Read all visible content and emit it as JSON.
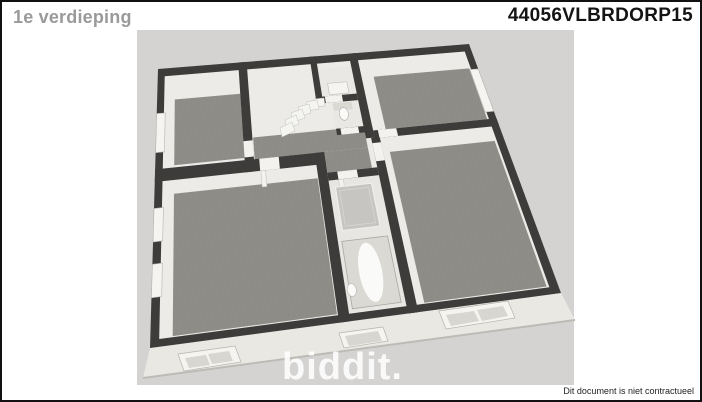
{
  "header": {
    "title": "1e verdieping",
    "code": "44056VLBRDORP15"
  },
  "watermark": {
    "text": "biddit."
  },
  "footer": {
    "disclaimer": "Dit document is niet contractueel"
  },
  "floorplan": {
    "type": "isometric-3d-floor-plan",
    "floor": "first floor",
    "rooms_visible": [
      "bedroom-top-left",
      "stair-hall-with-stairs",
      "wc-room",
      "toilet-nook",
      "bedroom-top-right",
      "bedroom-bottom-left",
      "bathroom-with-tub-and-shower",
      "bedroom-bottom-right"
    ],
    "features": [
      "staircase",
      "bathtub",
      "shower",
      "toilet",
      "facade-roof-windows",
      "wall-windows"
    ]
  },
  "colors": {
    "page_bg": "#ffffff",
    "border": "#111111",
    "plan_bg": "#d4d3d1",
    "wall": "#3d3c3a",
    "wall_face": "#ecebe7",
    "wood_floor": "#8f8d88",
    "wood_streak": "#7e7c77",
    "tile_floor": "#e9e8e4",
    "bath_floor": "#e7e6e2",
    "facade": "#eae8e3",
    "facade_edge": "#bdbbb6",
    "frame_white": "#f5f4f1",
    "frame_stroke": "#b5b3ae",
    "pane_gray": "#d8d6d0",
    "door_white": "#f3f2ef",
    "stair_white": "#f4f4f1",
    "fixture_white": "#fafaf8",
    "fixture_gray": "#dbd9d4",
    "glass": "#c6c5c1",
    "title_gray": "#9a9a9a",
    "code_black": "#141414",
    "disclaimer_text": "#222222",
    "watermark_white": "#ffffff"
  }
}
